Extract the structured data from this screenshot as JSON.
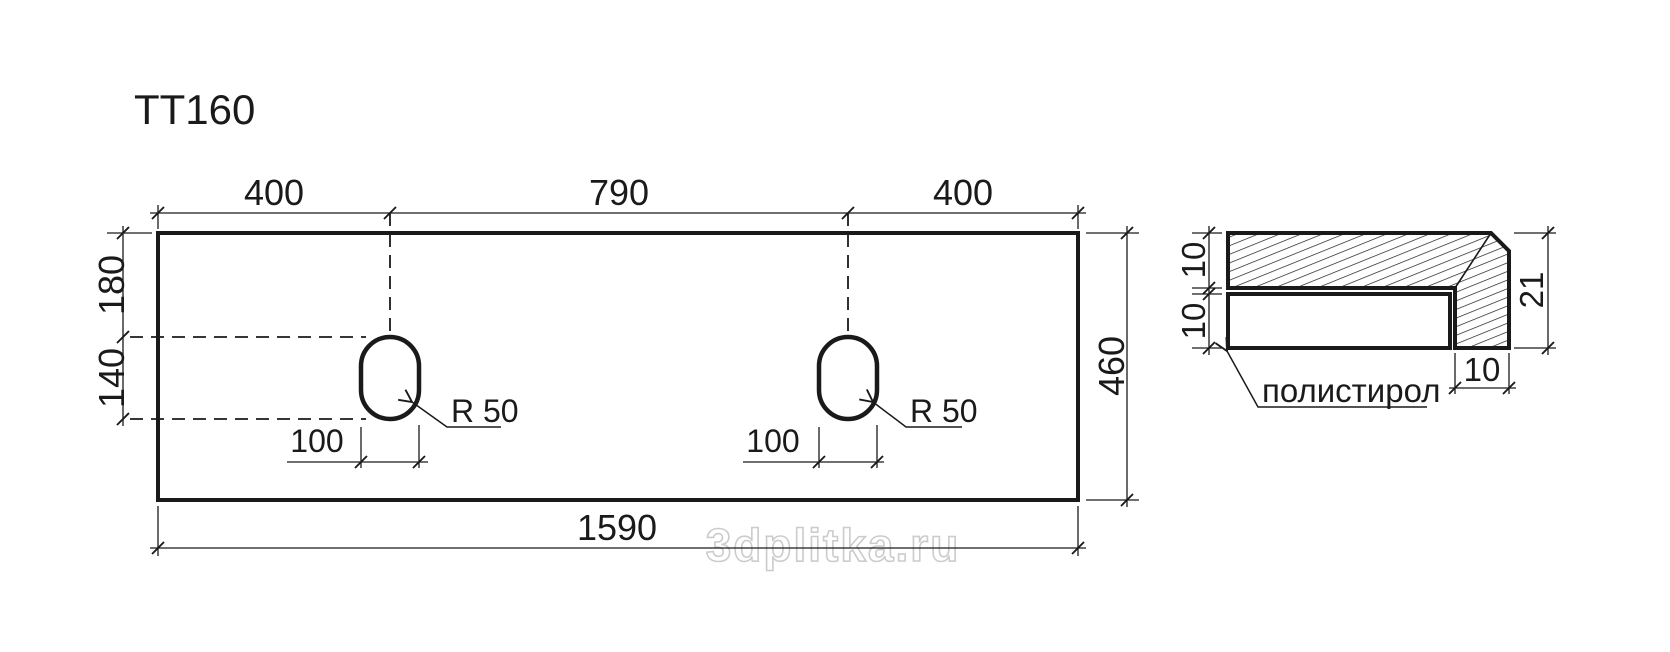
{
  "title": "TT160",
  "watermark": "3dplitka.ru",
  "colors": {
    "line": "#1a1a1a",
    "watermark_outline": "#cccccc",
    "background": "#ffffff"
  },
  "plan": {
    "dim_top_left": "400",
    "dim_top_middle": "790",
    "dim_top_right": "400",
    "dim_left_upper": "180",
    "dim_left_lower": "140",
    "dim_bottom": "1590",
    "dim_right": "460",
    "hole1": {
      "width_dim": "100",
      "radius_label": "R 50"
    },
    "hole2": {
      "width_dim": "100",
      "radius_label": "R 50"
    }
  },
  "section": {
    "dim_tile_thickness": "10",
    "dim_core_thickness": "10",
    "dim_total_height": "21",
    "dim_edge_width": "10",
    "material_label": "полистирол"
  }
}
